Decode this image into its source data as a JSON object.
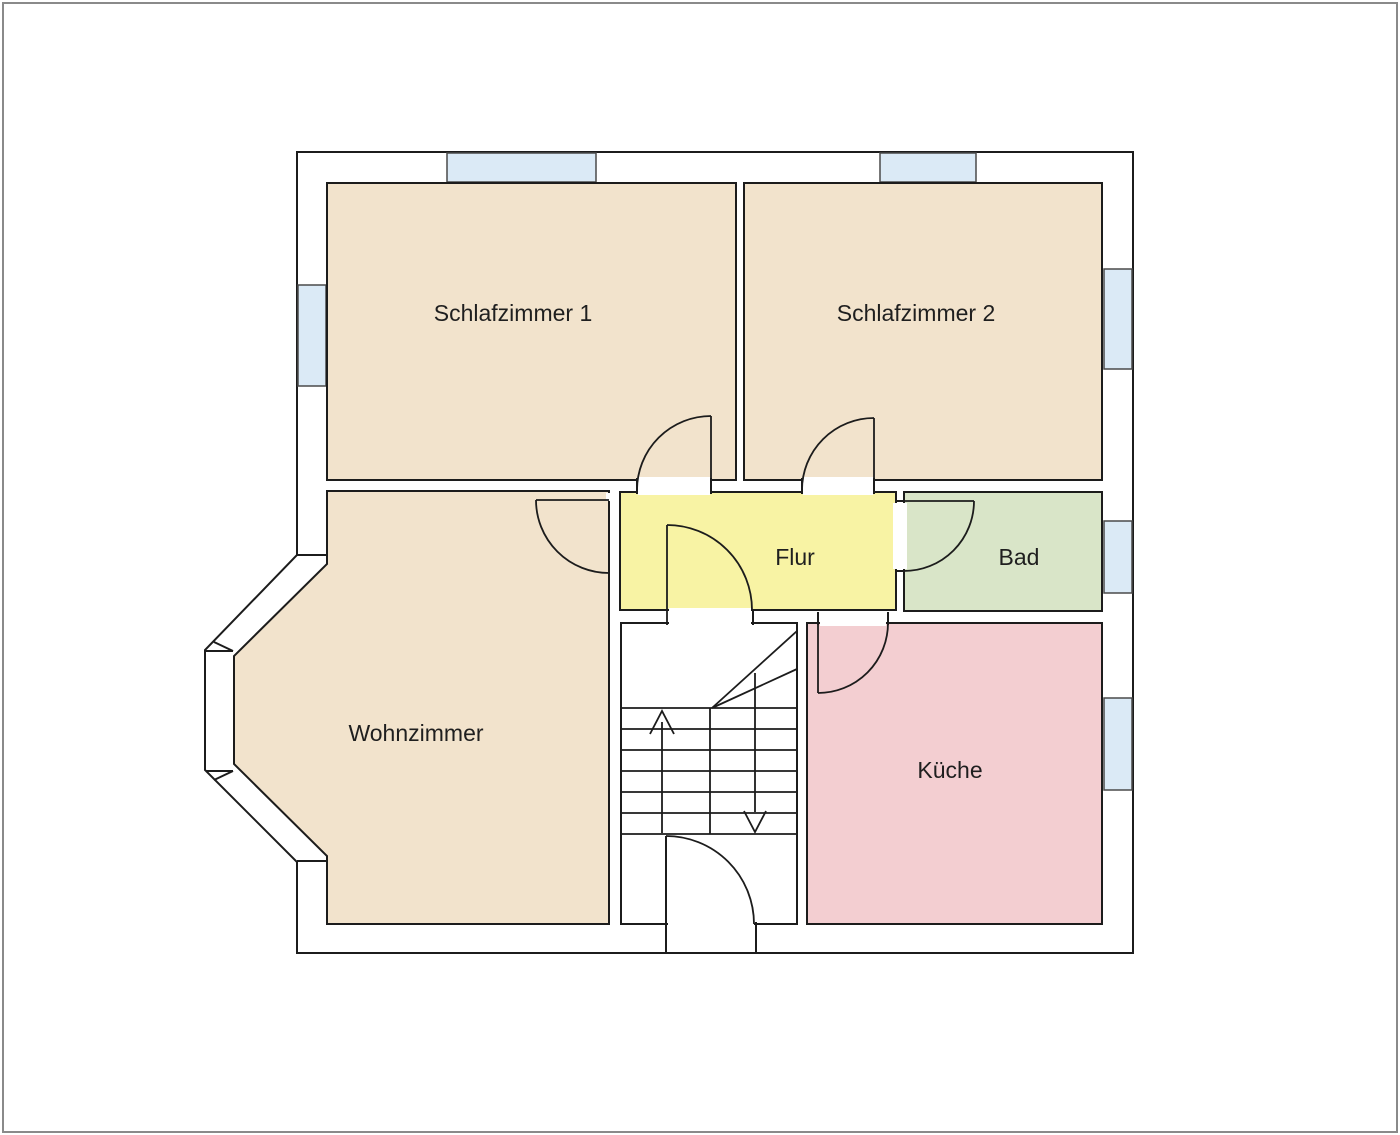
{
  "floor_plan": {
    "type": "residential-floor-plan",
    "wall_color": "#1c1c1c",
    "window_color": "#dbeaf6",
    "frame_color": "#8a8a8a",
    "label_color": "#1f1f1f",
    "rooms": {
      "schlafzimmer1": {
        "label": "Schlafzimmer 1",
        "color": "#f2e3cc"
      },
      "schlafzimmer2": {
        "label": "Schlafzimmer 2",
        "color": "#f2e3cc"
      },
      "flur": {
        "label": "Flur",
        "color": "#f8f3a4"
      },
      "bad": {
        "label": "Bad",
        "color": "#d9e5c8"
      },
      "wohnzimmer": {
        "label": "Wohnzimmer",
        "color": "#f2e3cc"
      },
      "kueche": {
        "label": "Küche",
        "color": "#f3ced1"
      },
      "treppenhaus": {
        "label": "",
        "color": "#ffffff"
      }
    }
  }
}
